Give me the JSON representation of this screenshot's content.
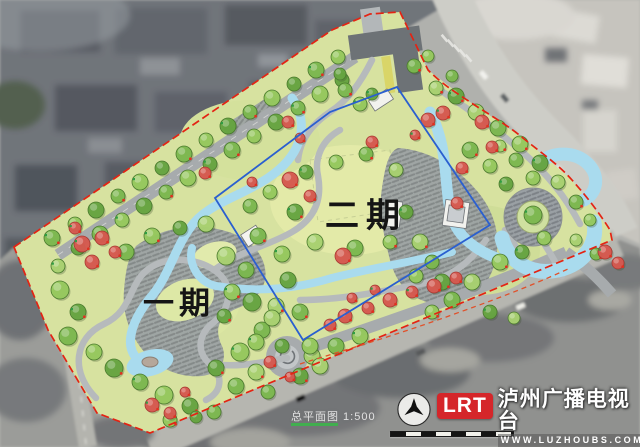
{
  "plan": {
    "phase1_label": "一期",
    "phase2_label": "二期",
    "scale_note": "总平面图 1:500"
  },
  "watermark": {
    "logo_text": "LRT",
    "station_name": "泸州广播电视台",
    "website": "WWW.LUZHOUBS.COM"
  },
  "colors": {
    "boundary_red": "#e42313",
    "curb_dash_red": "#e0512a",
    "phase_divider_blue": "#2a5fd0",
    "water": "#a9dbee",
    "park_base": "#d7e2a0",
    "lawn_light": "#e3eaa8",
    "path_gray": "#aeb3b5",
    "plaza_hatch_bg": "#9aa0a4",
    "canopy_greens": [
      "#7cb84f",
      "#96c95e",
      "#66a441",
      "#a9d170"
    ],
    "canopy_stroke": "#4a7a2e",
    "flower_tree": "#d6584f",
    "flower_stroke": "#a83a33",
    "marker_red": "#e03020",
    "marker_green": "#2f9e44",
    "logo_red": "#d5262a"
  },
  "map_features": {
    "trees": [
      [
        52,
        238,
        8,
        0
      ],
      [
        75,
        224,
        7,
        1
      ],
      [
        96,
        210,
        8,
        2
      ],
      [
        118,
        196,
        7,
        0
      ],
      [
        140,
        182,
        8,
        1
      ],
      [
        162,
        168,
        7,
        2
      ],
      [
        184,
        154,
        8,
        0
      ],
      [
        206,
        140,
        7,
        1
      ],
      [
        228,
        126,
        8,
        2
      ],
      [
        250,
        112,
        7,
        0
      ],
      [
        272,
        98,
        8,
        1
      ],
      [
        294,
        84,
        7,
        2
      ],
      [
        316,
        70,
        8,
        0
      ],
      [
        338,
        57,
        7,
        1
      ],
      [
        78,
        248,
        7,
        2
      ],
      [
        100,
        234,
        8,
        0
      ],
      [
        122,
        220,
        7,
        1
      ],
      [
        144,
        206,
        8,
        2
      ],
      [
        166,
        192,
        7,
        0
      ],
      [
        188,
        178,
        8,
        1
      ],
      [
        210,
        164,
        7,
        2
      ],
      [
        232,
        150,
        8,
        0
      ],
      [
        254,
        136,
        7,
        1
      ],
      [
        276,
        122,
        8,
        2
      ],
      [
        298,
        108,
        7,
        0
      ],
      [
        320,
        94,
        8,
        1
      ],
      [
        342,
        80,
        7,
        2
      ],
      [
        345,
        90,
        7,
        0
      ],
      [
        360,
        104,
        7,
        1
      ],
      [
        340,
        74,
        6,
        2
      ],
      [
        414,
        66,
        7,
        0
      ],
      [
        428,
        56,
        6,
        1
      ],
      [
        372,
        94,
        6,
        2
      ],
      [
        436,
        88,
        7,
        3
      ],
      [
        452,
        76,
        6,
        0
      ],
      [
        60,
        290,
        9,
        1
      ],
      [
        78,
        312,
        8,
        2
      ],
      [
        68,
        336,
        9,
        0
      ],
      [
        94,
        352,
        8,
        1
      ],
      [
        114,
        368,
        9,
        2
      ],
      [
        140,
        382,
        8,
        0
      ],
      [
        164,
        395,
        9,
        1
      ],
      [
        190,
        406,
        8,
        2
      ],
      [
        214,
        412,
        7,
        0
      ],
      [
        58,
        266,
        7,
        3
      ],
      [
        170,
        420,
        7,
        1
      ],
      [
        196,
        417,
        6,
        2
      ],
      [
        126,
        252,
        8,
        0
      ],
      [
        152,
        236,
        8,
        1
      ],
      [
        180,
        228,
        7,
        2
      ],
      [
        206,
        224,
        8,
        3
      ],
      [
        258,
        236,
        8,
        0
      ],
      [
        282,
        254,
        8,
        1
      ],
      [
        288,
        280,
        8,
        2
      ],
      [
        276,
        306,
        8,
        3
      ],
      [
        262,
        330,
        8,
        0
      ],
      [
        240,
        352,
        9,
        1
      ],
      [
        216,
        368,
        8,
        2
      ],
      [
        226,
        256,
        9,
        3
      ],
      [
        246,
        270,
        8,
        0
      ],
      [
        232,
        292,
        8,
        1
      ],
      [
        252,
        302,
        9,
        2
      ],
      [
        272,
        318,
        8,
        3
      ],
      [
        300,
        312,
        8,
        0
      ],
      [
        256,
        342,
        8,
        1
      ],
      [
        282,
        346,
        7,
        2
      ],
      [
        312,
        356,
        8,
        3
      ],
      [
        336,
        346,
        8,
        0
      ],
      [
        360,
        336,
        8,
        1
      ],
      [
        224,
        316,
        7,
        2
      ],
      [
        250,
        206,
        7,
        0
      ],
      [
        270,
        192,
        7,
        1
      ],
      [
        295,
        212,
        8,
        2
      ],
      [
        315,
        242,
        8,
        3
      ],
      [
        355,
        248,
        8,
        0
      ],
      [
        390,
        242,
        7,
        1
      ],
      [
        406,
        212,
        7,
        2
      ],
      [
        396,
        170,
        7,
        3
      ],
      [
        366,
        154,
        7,
        0
      ],
      [
        336,
        162,
        7,
        1
      ],
      [
        306,
        172,
        7,
        2
      ],
      [
        420,
        242,
        8,
        3
      ],
      [
        432,
        262,
        7,
        0
      ],
      [
        416,
        276,
        7,
        1
      ],
      [
        442,
        282,
        8,
        2
      ],
      [
        472,
        282,
        8,
        3
      ],
      [
        452,
        300,
        8,
        0
      ],
      [
        432,
        312,
        7,
        1
      ],
      [
        490,
        312,
        7,
        2
      ],
      [
        514,
        318,
        6,
        3
      ],
      [
        470,
        150,
        8,
        0
      ],
      [
        490,
        166,
        7,
        1
      ],
      [
        506,
        184,
        7,
        2
      ],
      [
        500,
        146,
        6,
        3
      ],
      [
        516,
        160,
        7,
        0
      ],
      [
        533,
        178,
        7,
        1
      ],
      [
        456,
        96,
        8,
        2
      ],
      [
        476,
        112,
        8,
        3
      ],
      [
        498,
        128,
        8,
        0
      ],
      [
        520,
        144,
        8,
        1
      ],
      [
        540,
        163,
        8,
        2
      ],
      [
        558,
        182,
        7,
        3
      ],
      [
        576,
        202,
        7,
        0
      ],
      [
        590,
        220,
        6,
        1
      ],
      [
        533,
        215,
        9,
        0
      ],
      [
        256,
        372,
        8,
        3
      ],
      [
        236,
        386,
        8,
        0
      ],
      [
        310,
        346,
        8,
        1
      ],
      [
        300,
        376,
        8,
        2
      ],
      [
        320,
        366,
        8,
        3
      ],
      [
        268,
        392,
        7,
        0
      ],
      [
        500,
        262,
        8,
        1
      ],
      [
        522,
        252,
        7,
        2
      ],
      [
        576,
        240,
        6,
        3
      ],
      [
        596,
        254,
        6,
        0
      ],
      [
        544,
        238,
        7,
        1
      ]
    ],
    "red_trees": [
      [
        82,
        244,
        8
      ],
      [
        102,
        238,
        7
      ],
      [
        92,
        262,
        7
      ],
      [
        115,
        252,
        6
      ],
      [
        75,
        228,
        6
      ],
      [
        205,
        173,
        6
      ],
      [
        252,
        182,
        5
      ],
      [
        288,
        122,
        6
      ],
      [
        300,
        138,
        5
      ],
      [
        290,
        180,
        8
      ],
      [
        310,
        196,
        6
      ],
      [
        428,
        120,
        7
      ],
      [
        443,
        113,
        7
      ],
      [
        482,
        122,
        7
      ],
      [
        462,
        168,
        6
      ],
      [
        457,
        203,
        6
      ],
      [
        415,
        135,
        5
      ],
      [
        345,
        316,
        7
      ],
      [
        368,
        308,
        6
      ],
      [
        390,
        300,
        7
      ],
      [
        412,
        292,
        6
      ],
      [
        434,
        286,
        7
      ],
      [
        456,
        278,
        6
      ],
      [
        352,
        298,
        5
      ],
      [
        375,
        290,
        5
      ],
      [
        330,
        325,
        6
      ],
      [
        270,
        362,
        6
      ],
      [
        290,
        377,
        5
      ],
      [
        152,
        405,
        7
      ],
      [
        170,
        413,
        6
      ],
      [
        185,
        392,
        5
      ],
      [
        492,
        147,
        6
      ],
      [
        605,
        252,
        7
      ],
      [
        618,
        263,
        6
      ],
      [
        372,
        142,
        6
      ],
      [
        343,
        256,
        8
      ]
    ]
  }
}
